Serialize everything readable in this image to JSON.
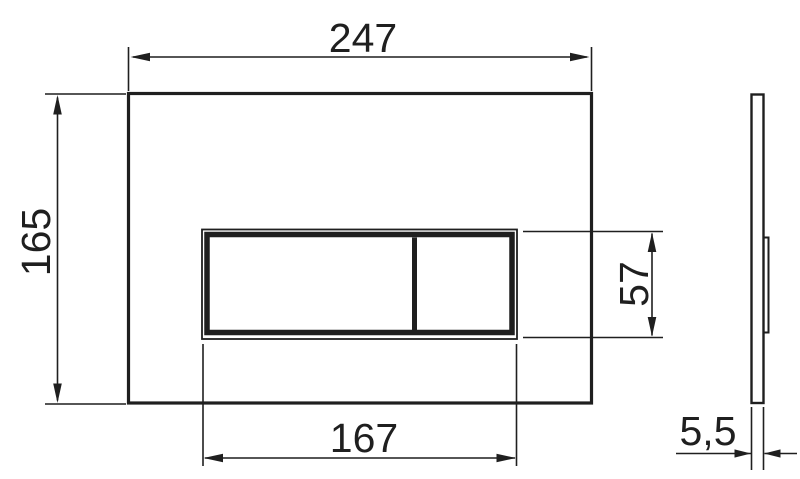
{
  "drawing": {
    "background": "#ffffff",
    "line_color": "#1f1f1f",
    "dimensions": {
      "plate_width": "247",
      "plate_height": "165",
      "button_panel_width": "167",
      "button_panel_height": "57",
      "plate_thickness": "5,5"
    }
  }
}
